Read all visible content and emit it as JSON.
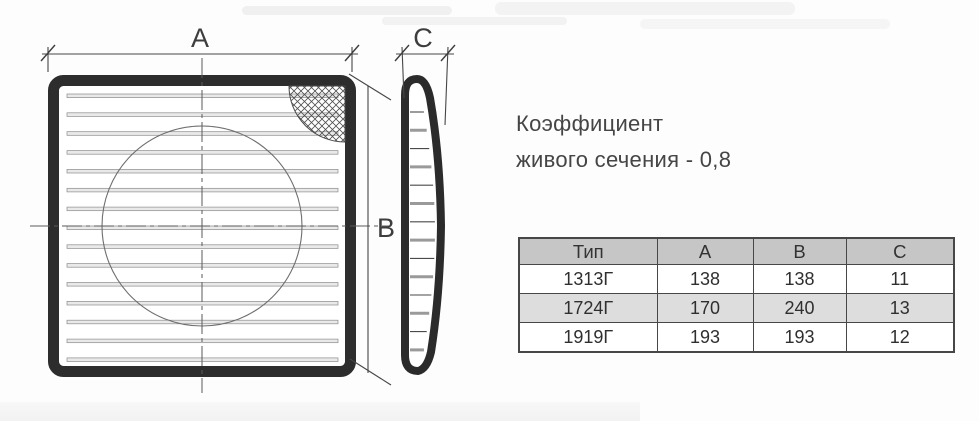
{
  "annotation": {
    "line1": "Коэффициент",
    "line2": "живого сечения - 0,8"
  },
  "drawing": {
    "dim_a_label": "A",
    "dim_b_label": "B",
    "dim_c_label": "C"
  },
  "spec_table": {
    "headers": [
      "Тип",
      "A",
      "B",
      "C"
    ],
    "rows": [
      [
        "1313Г",
        "138",
        "138",
        "11"
      ],
      [
        "1724Г",
        "170",
        "240",
        "13"
      ],
      [
        "1919Г",
        "193",
        "193",
        "12"
      ]
    ]
  },
  "colors": {
    "drawing_line": "#2d2d2d",
    "table_header_bg": "#c6c6c6",
    "table_alt_row_bg": "#dddddd",
    "table_border": "#474747",
    "text": "#454545"
  }
}
